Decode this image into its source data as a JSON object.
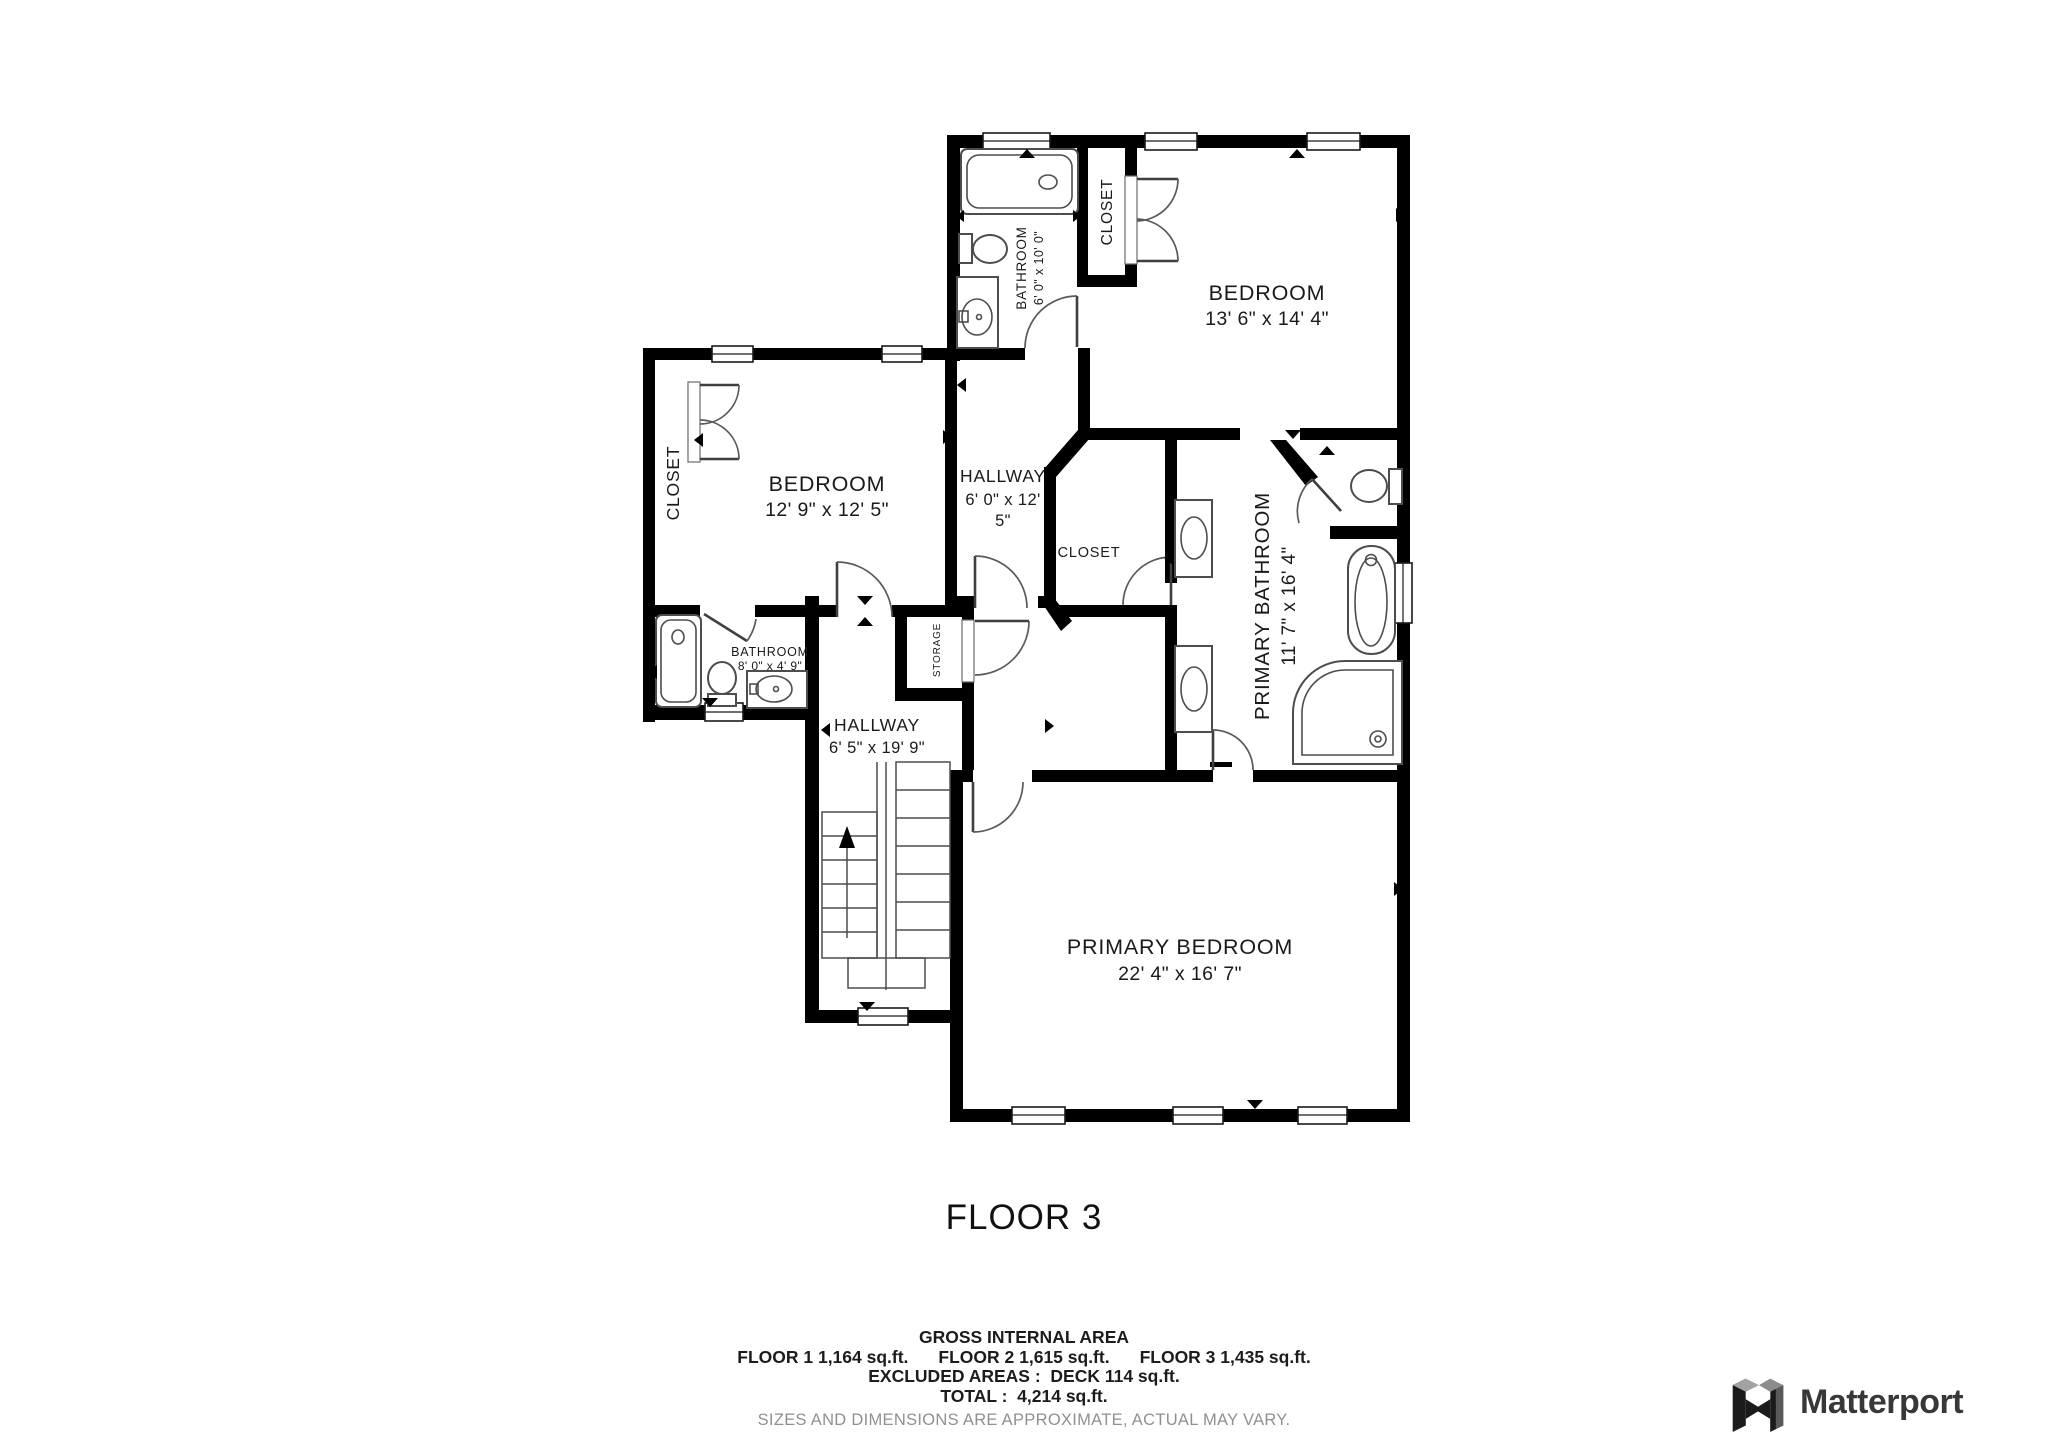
{
  "floor_title": "FLOOR 3",
  "rooms": {
    "bathroom_top": {
      "label": "BATHROOM",
      "dims": "6' 0\" x 10' 0\""
    },
    "closet_top": {
      "label": "CLOSET"
    },
    "bedroom_top": {
      "label": "BEDROOM",
      "dims": "13' 6\" x 14' 4\""
    },
    "closet_left": {
      "label": "CLOSET"
    },
    "bedroom_mid": {
      "label": "BEDROOM",
      "dims": "12' 9\" x 12' 5\""
    },
    "hallway_upper": {
      "label": "HALLWAY",
      "dims_line1": "6' 0\" x 12'",
      "dims_line2": "5\""
    },
    "closet_mid": {
      "label": "CLOSET"
    },
    "primary_bathroom": {
      "label": "PRIMARY BATHROOM",
      "dims": "11' 7\" x 16' 4\""
    },
    "bathroom_small": {
      "label": "BATHROOM",
      "dims": "8' 0\" x 4' 9\""
    },
    "storage": {
      "label": "STORAGE"
    },
    "hallway_lower": {
      "label": "HALLWAY",
      "dims": "6' 5\" x 19' 9\""
    },
    "primary_bedroom": {
      "label": "PRIMARY BEDROOM",
      "dims": "22' 4\" x 16' 7\""
    }
  },
  "summary": {
    "title": "GROSS INTERNAL AREA",
    "floor1": "FLOOR 1 1,164 sq.ft.",
    "floor2": "FLOOR 2 1,615 sq.ft.",
    "floor3": "FLOOR 3 1,435 sq.ft.",
    "excluded": "EXCLUDED AREAS :  DECK 114 sq.ft.",
    "total": "TOTAL :  4,214 sq.ft.",
    "disclaimer": "SIZES AND DIMENSIONS ARE APPROXIMATE, ACTUAL MAY VARY."
  },
  "branding": {
    "logo_text": "Matterport"
  },
  "colors": {
    "wall": "#000000",
    "fixture": "#4d4d4d",
    "muted_text": "#909090"
  }
}
